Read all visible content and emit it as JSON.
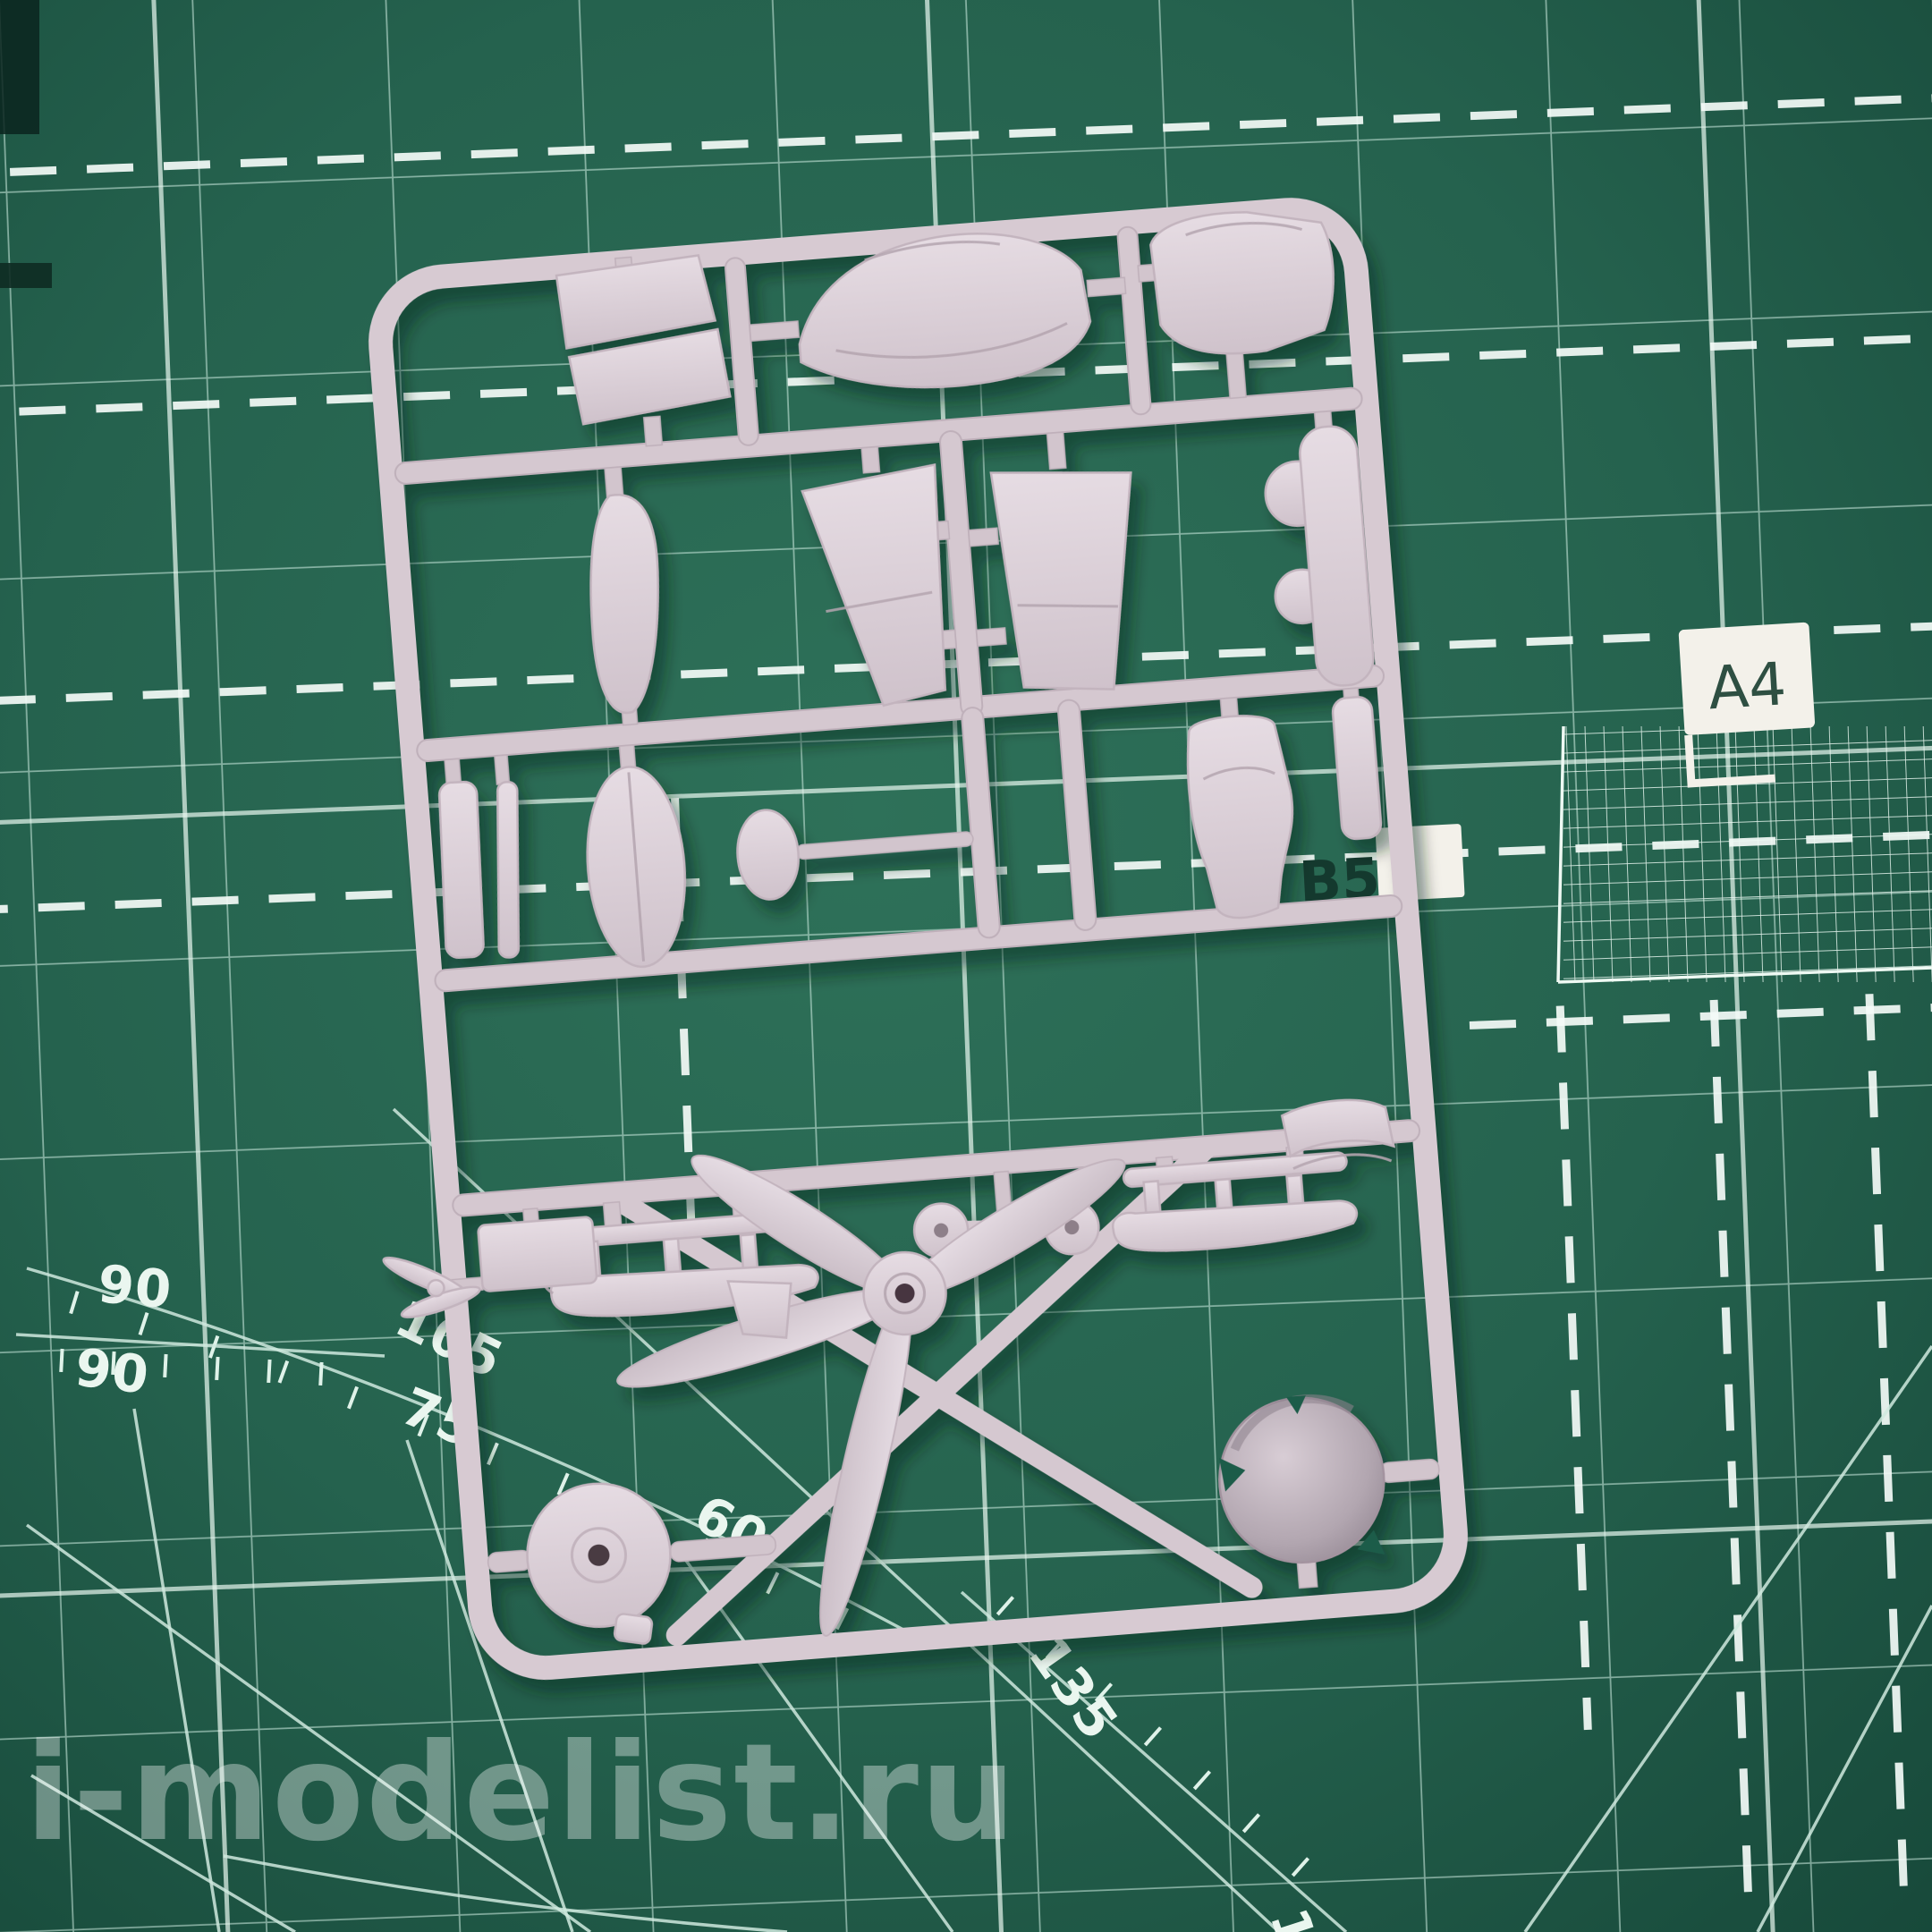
{
  "scene": {
    "type": "photograph",
    "subject": "plastic model kit sprue with aircraft parts on a green cutting mat",
    "plastic_color": "#d8ccd4",
    "mat_base_color": "#256049",
    "mat_grid_color": "#cfe9dd",
    "mat_dash_color": "#f4fbf7"
  },
  "mat": {
    "size_labels": {
      "a4": "A4",
      "b5": "B5"
    },
    "angle_labels": [
      "90",
      "90",
      "105",
      "75",
      "60",
      "135",
      "150"
    ],
    "features": [
      "grid",
      "dashed-lines",
      "protractor-arc",
      "angle-rays",
      "fine-mesh-grid"
    ]
  },
  "sprue": {
    "part_names": [
      "windshield-halves",
      "fuselage-half",
      "nose-cowling",
      "wing-panel-slender",
      "wing-panel-upper",
      "wing-panel-lower",
      "fuselage-side-with-bumps",
      "side-strip",
      "thin-strut",
      "cowl-dome",
      "spinner-backplate",
      "pilot-seat",
      "panel-strip",
      "ski-left",
      "ski-right",
      "wheel-axle",
      "small-block",
      "four-blade-propeller",
      "main-wheel",
      "spinner-dome",
      "cowl-flap",
      "tiny-propeller",
      "winglet"
    ]
  },
  "watermark": {
    "text": "i-modelist.ru"
  }
}
